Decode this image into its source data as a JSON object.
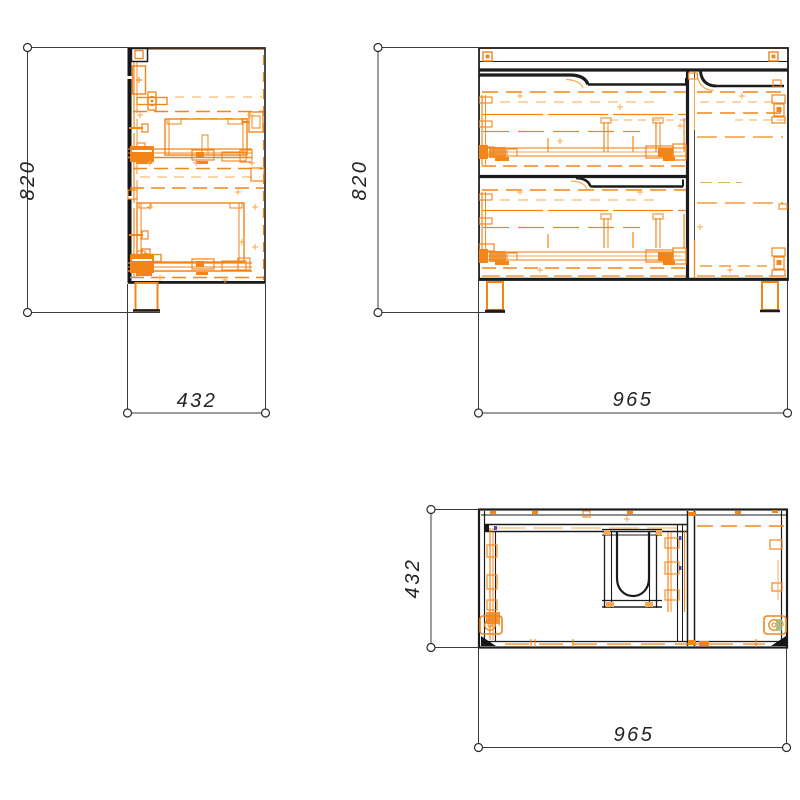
{
  "drawing": {
    "description": "Technical drawing of a vanity cabinet: side, front and top orthographic views with millimetre dimensions",
    "views": {
      "side": {
        "label_height": "820",
        "label_depth": "432"
      },
      "front": {
        "label_height": "820",
        "label_width": "965"
      },
      "top": {
        "label_depth": "432",
        "label_width": "965"
      }
    },
    "colors": {
      "outline": "#1c1c1c",
      "hardware": "#f28418",
      "hardware_light": "#f9a94e",
      "dimension": "#3a3a3a",
      "background": "#ffffff"
    }
  }
}
